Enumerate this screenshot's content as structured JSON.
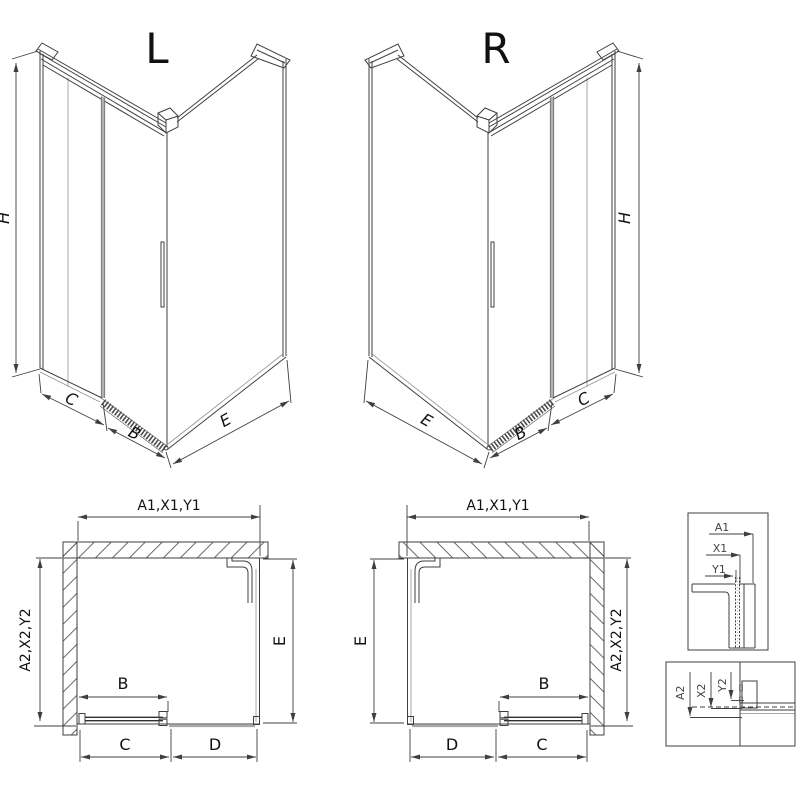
{
  "colors": {
    "line": "#3f3f3f",
    "glass_line": "#939393",
    "door_grey": "#b0b0b0",
    "text": "#111111",
    "background": "#ffffff"
  },
  "views": {
    "iso_left": {
      "label": "L",
      "dim_h": "H",
      "dim_c": "C",
      "dim_b": "B",
      "dim_e": "E"
    },
    "iso_right": {
      "label": "R",
      "dim_h": "H",
      "dim_c": "C",
      "dim_b": "B",
      "dim_e": "E"
    },
    "plan_left": {
      "dim_top": "A1,X1,Y1",
      "dim_side": "A2,X2,Y2",
      "dim_e": "E",
      "dim_b": "B",
      "dim_c": "C",
      "dim_d": "D"
    },
    "plan_right": {
      "dim_top": "A1,X1,Y1",
      "dim_side": "A2,X2,Y2",
      "dim_e": "E",
      "dim_b": "B",
      "dim_c": "C",
      "dim_d": "D"
    },
    "detail_top": {
      "dim_a1": "A1",
      "dim_x1": "X1",
      "dim_y1": "Y1"
    },
    "detail_bottom": {
      "dim_a2": "A2",
      "dim_x2": "X2",
      "dim_y2": "Y2"
    }
  }
}
